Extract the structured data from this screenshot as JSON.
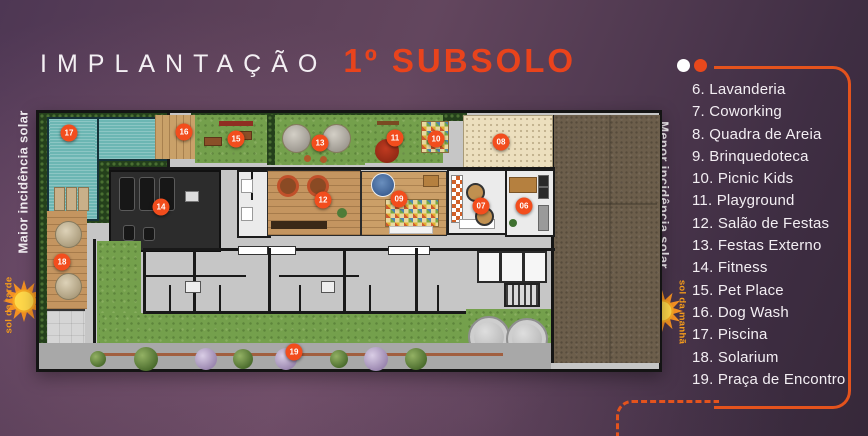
{
  "header": {
    "title_regular": "IMPLANTAÇÃO",
    "title_accent": "1º SUBSOLO"
  },
  "solar_labels": {
    "left": {
      "label": "Maior incidência solar",
      "sun_label": "sol da tarde"
    },
    "right": {
      "label": "Menor incidência solar",
      "sun_label": "sol da manhã"
    }
  },
  "legend": {
    "items": [
      "6. Lavanderia",
      "7. Coworking",
      "8. Quadra de Areia",
      "9. Brinquedoteca",
      "10. Picnic Kids",
      "11. Playground",
      "12. Salão de Festas",
      "13. Festas Externo",
      "14. Fitness",
      "15. Pet Place",
      "16. Dog Wash",
      "17. Piscina",
      "18. Solarium",
      "19. Praça de Encontro"
    ]
  },
  "plan": {
    "markers": [
      {
        "label": "06"
      },
      {
        "label": "07"
      },
      {
        "label": "08"
      },
      {
        "label": "09"
      },
      {
        "label": "10"
      },
      {
        "label": "11"
      },
      {
        "label": "12"
      },
      {
        "label": "13"
      },
      {
        "label": "14"
      },
      {
        "label": "15"
      },
      {
        "label": "16"
      },
      {
        "label": "17"
      },
      {
        "label": "18"
      },
      {
        "label": "19"
      }
    ]
  },
  "colors": {
    "accent_orange": "#e9431c",
    "legend_line": "#e4531d",
    "marker": "#f24d1d",
    "text_light": "#f3eef3",
    "sun_orange": "#f59c1b",
    "pool_teal": "#6cb6b3",
    "lawn_green": "#74a04c",
    "earth_brown": "#6c5e4b"
  }
}
